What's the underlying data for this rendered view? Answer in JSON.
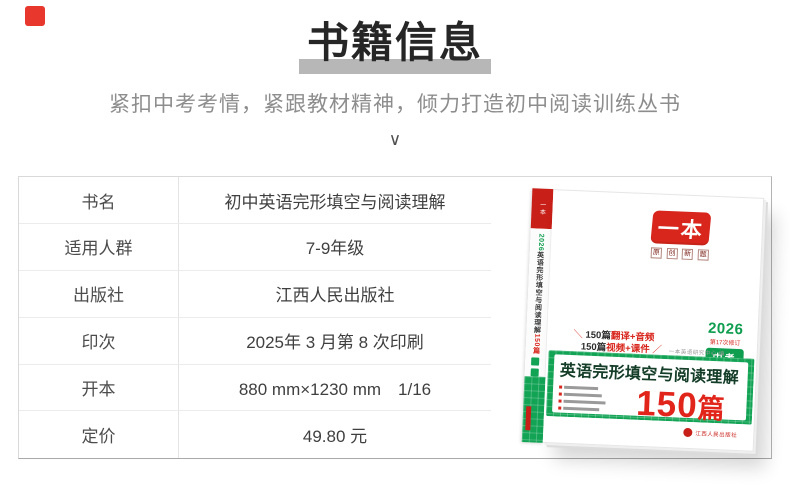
{
  "header": {
    "title": "书籍信息",
    "subtitle": "紧扣中考考情，紧跟教材精神，倾力打造初中阅读训练丛书",
    "chevron": "∨"
  },
  "info_table": {
    "rows": [
      {
        "label": "书名",
        "value": "初中英语完形填空与阅读理解"
      },
      {
        "label": "适用人群",
        "value": "7-9年级"
      },
      {
        "label": "出版社",
        "value": "江西人民出版社"
      },
      {
        "label": "印次",
        "value": "2025年 3 月第 8 次印刷"
      },
      {
        "label": "开本",
        "value": "880 mm×1230 mm　1/16"
      },
      {
        "label": "定价",
        "value": "49.80 元"
      }
    ]
  },
  "book": {
    "brand": "一本",
    "brand_sub": "原创新题",
    "year": "2026",
    "revision": "第17次修订",
    "exam_badge": "中考",
    "slash_left": "＼",
    "slash_right": "／",
    "feature1_black": "150篇",
    "feature1_red": "翻译+音频",
    "feature2_black": "150篇",
    "feature2_red": "视频+课件",
    "editor": "一本英语研究中心 编",
    "title": "英语完形填空与阅读理解",
    "count_num": "150",
    "count_unit": "篇",
    "publisher": "江西人民出版社",
    "spine_year": "2026",
    "spine_title": "英语完形填空与阅读理解",
    "spine_count": "150篇"
  }
}
